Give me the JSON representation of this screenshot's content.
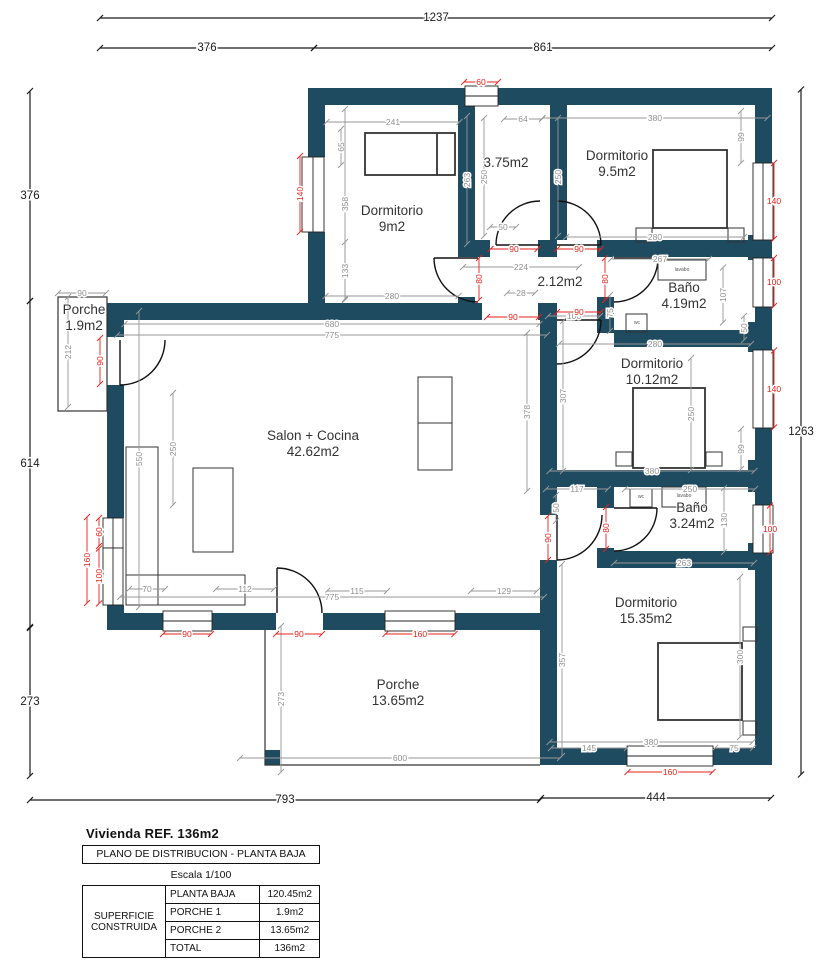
{
  "colors": {
    "wall": "#1f4b61",
    "dim_red": "#e8201a",
    "dim_gray": "#979797",
    "dim_dark": "#1a1a1a",
    "line": "#2b2b2b"
  },
  "title_block": {
    "title": "Vivienda REF. 136m2",
    "subtitle": "PLANO DE DISTRIBUCION - PLANTA BAJA",
    "scale": "Escala 1/100",
    "table": {
      "row_header": "SUPERFICIE CONSTRUIDA",
      "rows": [
        {
          "label": "PLANTA BAJA",
          "value": "120.45m2"
        },
        {
          "label": "PORCHE 1",
          "value": "1.9m2"
        },
        {
          "label": "PORCHE 2",
          "value": "13.65m2"
        },
        {
          "label": "TOTAL",
          "value": "136m2"
        }
      ]
    }
  },
  "rooms": [
    {
      "name": "Dormitorio",
      "area": "9m2",
      "x": 392,
      "y": 215
    },
    {
      "name": "",
      "area": "3.75m2",
      "x": 506,
      "y": 160
    },
    {
      "name": "Dormitorio",
      "area": "9.5m2",
      "x": 617,
      "y": 160
    },
    {
      "name": "",
      "area": "2.12m2",
      "x": 560,
      "y": 279
    },
    {
      "name": "Baño",
      "area": "4.19m2",
      "x": 684,
      "y": 292
    },
    {
      "name": "Dormitorio",
      "area": "10.12m2",
      "x": 652,
      "y": 368
    },
    {
      "name": "Salon + Cocina",
      "area": "42.62m2",
      "x": 313,
      "y": 440
    },
    {
      "name": "Porche",
      "area": "1.9m2",
      "x": 84,
      "y": 314
    },
    {
      "name": "Baño",
      "area": "3.24m2",
      "x": 692,
      "y": 512
    },
    {
      "name": "Dormitorio",
      "area": "15.35m2",
      "x": 646,
      "y": 607
    },
    {
      "name": "Porche",
      "area": "13.65m2",
      "x": 398,
      "y": 689
    }
  ],
  "fixtures": [
    {
      "t": "lavabo",
      "x": 682,
      "y": 271
    },
    {
      "t": "wc",
      "x": 637,
      "y": 324
    },
    {
      "t": "wc",
      "x": 641,
      "y": 498
    },
    {
      "t": "lavabo",
      "x": 684,
      "y": 497
    }
  ],
  "dims": [
    {
      "t": "1237",
      "x": 436,
      "y": 18,
      "o": "h",
      "l": 672,
      "c": "black"
    },
    {
      "t": "376",
      "x": 207,
      "y": 48,
      "o": "h",
      "l": 214,
      "c": "black"
    },
    {
      "t": "861",
      "x": 543,
      "y": 48,
      "o": "h",
      "l": 458,
      "c": "black"
    },
    {
      "t": "376",
      "x": 30,
      "y": 196,
      "o": "v",
      "l": 210,
      "c": "black"
    },
    {
      "t": "614",
      "x": 30,
      "y": 464,
      "o": "v",
      "l": 326,
      "c": "black"
    },
    {
      "t": "273",
      "x": 30,
      "y": 702,
      "o": "v",
      "l": 148,
      "c": "black"
    },
    {
      "t": "1263",
      "x": 801,
      "y": 432,
      "o": "v",
      "l": 685,
      "c": "black"
    },
    {
      "t": "793",
      "x": 285,
      "y": 800,
      "o": "h",
      "l": 510,
      "c": "black"
    },
    {
      "t": "444",
      "x": 656,
      "y": 798,
      "o": "h",
      "l": 230,
      "c": "black"
    },
    {
      "t": "90",
      "x": 82,
      "y": 293,
      "o": "h",
      "l": 48,
      "c": "gray"
    },
    {
      "t": "212",
      "x": 68,
      "y": 352,
      "o": "v",
      "l": 110,
      "c": "gray",
      "r": 1
    },
    {
      "t": "241",
      "x": 393,
      "y": 122,
      "o": "h",
      "l": 133,
      "c": "gray"
    },
    {
      "t": "65",
      "x": 341,
      "y": 147,
      "o": "v",
      "l": 36,
      "c": "gray",
      "r": 1
    },
    {
      "t": "358",
      "x": 345,
      "y": 204,
      "o": "v",
      "l": 190,
      "c": "gray",
      "r": 1
    },
    {
      "t": "133",
      "x": 345,
      "y": 271,
      "o": "v",
      "l": 58,
      "c": "gray",
      "r": 1
    },
    {
      "t": "280",
      "x": 392,
      "y": 296,
      "o": "h",
      "l": 133,
      "c": "gray"
    },
    {
      "t": "263",
      "x": 467,
      "y": 180,
      "o": "v",
      "l": 128,
      "c": "gray",
      "r": 1
    },
    {
      "t": "64",
      "x": 523,
      "y": 119,
      "o": "h",
      "l": 38,
      "c": "gray"
    },
    {
      "t": "250",
      "x": 484,
      "y": 177,
      "o": "v",
      "l": 118,
      "c": "gray",
      "r": 1
    },
    {
      "t": "250",
      "x": 558,
      "y": 177,
      "o": "v",
      "l": 118,
      "c": "gray",
      "r": 1
    },
    {
      "t": "50",
      "x": 503,
      "y": 227,
      "o": "h",
      "l": 26,
      "c": "gray"
    },
    {
      "t": "380",
      "x": 655,
      "y": 118,
      "o": "h",
      "l": 225,
      "c": "gray"
    },
    {
      "t": "99",
      "x": 741,
      "y": 137,
      "o": "v",
      "l": 52,
      "c": "gray",
      "r": 1
    },
    {
      "t": "280",
      "x": 655,
      "y": 237,
      "o": "h",
      "l": 178,
      "c": "gray"
    },
    {
      "t": "267",
      "x": 660,
      "y": 259,
      "o": "h",
      "l": 98,
      "c": "gray"
    },
    {
      "t": "107",
      "x": 723,
      "y": 295,
      "o": "v",
      "l": 55,
      "c": "gray",
      "r": 1
    },
    {
      "t": "75",
      "x": 610,
      "y": 313,
      "o": "v",
      "l": 36,
      "c": "gray",
      "r": 1
    },
    {
      "t": "280",
      "x": 655,
      "y": 344,
      "o": "h",
      "l": 192,
      "c": "gray"
    },
    {
      "t": "224",
      "x": 521,
      "y": 267,
      "o": "h",
      "l": 116,
      "c": "gray"
    },
    {
      "t": "28",
      "x": 521,
      "y": 293,
      "o": "h",
      "l": 28,
      "c": "gray"
    },
    {
      "t": "100",
      "x": 574,
      "y": 316,
      "o": "h",
      "l": 52,
      "c": "gray"
    },
    {
      "t": "680",
      "x": 332,
      "y": 324,
      "o": "h",
      "l": 415,
      "c": "gray"
    },
    {
      "t": "775",
      "x": 332,
      "y": 335,
      "o": "h",
      "l": 430,
      "c": "gray"
    },
    {
      "t": "250",
      "x": 173,
      "y": 449,
      "o": "v",
      "l": 112,
      "c": "gray",
      "r": 1
    },
    {
      "t": "550",
      "x": 139,
      "y": 459,
      "o": "v",
      "l": 296,
      "c": "gray",
      "r": 1
    },
    {
      "t": "378",
      "x": 527,
      "y": 412,
      "o": "v",
      "l": 158,
      "c": "gray",
      "r": 1
    },
    {
      "t": "307",
      "x": 563,
      "y": 396,
      "o": "v",
      "l": 150,
      "c": "gray",
      "r": 1
    },
    {
      "t": "250",
      "x": 691,
      "y": 414,
      "o": "v",
      "l": 112,
      "c": "gray",
      "r": 1
    },
    {
      "t": "99",
      "x": 741,
      "y": 449,
      "o": "v",
      "l": 40,
      "c": "gray",
      "r": 1
    },
    {
      "t": "50",
      "x": 744,
      "y": 328,
      "o": "v",
      "l": 24,
      "c": "gray",
      "r": 1
    },
    {
      "t": "380",
      "x": 652,
      "y": 471,
      "o": "h",
      "l": 205,
      "c": "gray"
    },
    {
      "t": "117",
      "x": 577,
      "y": 489,
      "o": "h",
      "l": 62,
      "c": "gray"
    },
    {
      "t": "50",
      "x": 556,
      "y": 508,
      "o": "v",
      "l": 26,
      "c": "gray",
      "r": 1
    },
    {
      "t": "250",
      "x": 690,
      "y": 489,
      "o": "h",
      "l": 130,
      "c": "gray"
    },
    {
      "t": "130",
      "x": 724,
      "y": 520,
      "o": "v",
      "l": 64,
      "c": "gray",
      "r": 1
    },
    {
      "t": "263",
      "x": 684,
      "y": 563,
      "o": "h",
      "l": 140,
      "c": "gray"
    },
    {
      "t": "357",
      "x": 562,
      "y": 660,
      "o": "v",
      "l": 192,
      "c": "gray",
      "r": 1
    },
    {
      "t": "300",
      "x": 740,
      "y": 657,
      "o": "v",
      "l": 160,
      "c": "gray",
      "r": 1
    },
    {
      "t": "380",
      "x": 651,
      "y": 742,
      "o": "h",
      "l": 203,
      "c": "gray"
    },
    {
      "t": "145",
      "x": 589,
      "y": 748,
      "o": "h",
      "l": 76,
      "c": "gray"
    },
    {
      "t": "75",
      "x": 734,
      "y": 748,
      "o": "h",
      "l": 38,
      "c": "gray"
    },
    {
      "t": "70",
      "x": 147,
      "y": 589,
      "o": "h",
      "l": 36,
      "c": "gray"
    },
    {
      "t": "112",
      "x": 245,
      "y": 589,
      "o": "h",
      "l": 58,
      "c": "gray"
    },
    {
      "t": "115",
      "x": 357,
      "y": 591,
      "o": "h",
      "l": 60,
      "c": "gray"
    },
    {
      "t": "129",
      "x": 504,
      "y": 591,
      "o": "h",
      "l": 66,
      "c": "gray"
    },
    {
      "t": "775",
      "x": 332,
      "y": 597,
      "o": "h",
      "l": 424,
      "c": "gray"
    },
    {
      "t": "273",
      "x": 281,
      "y": 699,
      "o": "v",
      "l": 146,
      "c": "gray",
      "r": 1
    },
    {
      "t": "600",
      "x": 400,
      "y": 758,
      "o": "h",
      "l": 320,
      "c": "gray"
    },
    {
      "t": "60",
      "x": 481,
      "y": 82,
      "o": "h",
      "l": 34,
      "c": "red"
    },
    {
      "t": "140",
      "x": 300,
      "y": 194,
      "o": "v",
      "l": 76,
      "c": "red",
      "r": 1
    },
    {
      "t": "90",
      "x": 100,
      "y": 361,
      "o": "v",
      "l": 46,
      "c": "red",
      "r": 1
    },
    {
      "t": "60",
      "x": 99,
      "y": 532,
      "o": "v",
      "l": 28,
      "c": "red",
      "r": 1
    },
    {
      "t": "160",
      "x": 87,
      "y": 560,
      "o": "v",
      "l": 86,
      "c": "red",
      "r": 1
    },
    {
      "t": "100",
      "x": 99,
      "y": 576,
      "o": "v",
      "l": 55,
      "c": "red",
      "r": 1
    },
    {
      "t": "90",
      "x": 187,
      "y": 634,
      "o": "h",
      "l": 48,
      "c": "red"
    },
    {
      "t": "90",
      "x": 299,
      "y": 634,
      "o": "h",
      "l": 46,
      "c": "red"
    },
    {
      "t": "160",
      "x": 420,
      "y": 634,
      "o": "h",
      "l": 69,
      "c": "red"
    },
    {
      "t": "90",
      "x": 514,
      "y": 249,
      "o": "h",
      "l": 47,
      "c": "red"
    },
    {
      "t": "90",
      "x": 579,
      "y": 249,
      "o": "h",
      "l": 44,
      "c": "red"
    },
    {
      "t": "80",
      "x": 479,
      "y": 279,
      "o": "v",
      "l": 42,
      "c": "red",
      "r": 1
    },
    {
      "t": "80",
      "x": 605,
      "y": 279,
      "o": "v",
      "l": 42,
      "c": "red",
      "r": 1
    },
    {
      "t": "90",
      "x": 513,
      "y": 317,
      "o": "h",
      "l": 52,
      "c": "red"
    },
    {
      "t": "90",
      "x": 579,
      "y": 312,
      "o": "h",
      "l": 44,
      "c": "red"
    },
    {
      "t": "140",
      "x": 774,
      "y": 201,
      "o": "v",
      "l": 76,
      "c": "red"
    },
    {
      "t": "100",
      "x": 774,
      "y": 282,
      "o": "v",
      "l": 48,
      "c": "red"
    },
    {
      "t": "140",
      "x": 774,
      "y": 389,
      "o": "v",
      "l": 77,
      "c": "red"
    },
    {
      "t": "100",
      "x": 770,
      "y": 529,
      "o": "v",
      "l": 47,
      "c": "red"
    },
    {
      "t": "90",
      "x": 548,
      "y": 538,
      "o": "v",
      "l": 44,
      "c": "red",
      "r": 1
    },
    {
      "t": "80",
      "x": 606,
      "y": 528,
      "o": "v",
      "l": 42,
      "c": "red",
      "r": 1
    },
    {
      "t": "160",
      "x": 670,
      "y": 772,
      "o": "h",
      "l": 85,
      "c": "red"
    }
  ]
}
